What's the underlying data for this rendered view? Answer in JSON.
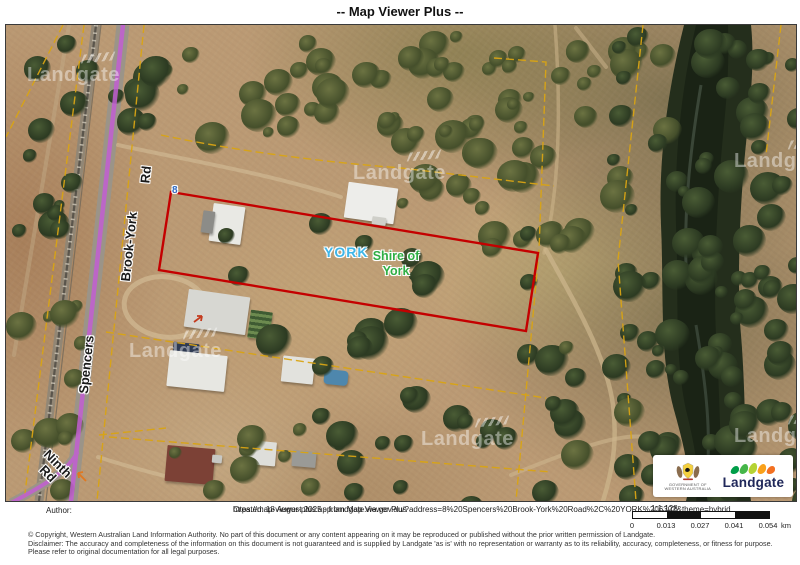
{
  "title": "-- Map Viewer Plus --",
  "map": {
    "watermark": "Landgate",
    "labels": {
      "road_part1": "Spencers",
      "road_part2": "Brook-York",
      "road_part3": "Rd",
      "ninth_line1": "Ninth",
      "ninth_line2": "Rd",
      "locality": "YORK",
      "lga_line1": "Shire of",
      "lga_line2": "York",
      "address_number": "8"
    },
    "colors": {
      "parcel_highlight": "#c40000",
      "route_highlight": "#c25ed2",
      "cadastral_line": "#d9a414",
      "locality_text": "#3fb6e8",
      "lga_text": "#2fae44",
      "address_text": "#2e6bc4"
    }
  },
  "logos": {
    "government_line1": "GOVERNMENT OF",
    "government_line2": "WESTERN AUSTRALIA",
    "landgate_text": "Landgate"
  },
  "footer": {
    "author_label": "Author:",
    "created_text": "Created: 18 August 2025 - from Map Viewer Plus",
    "url_text": "https://map-viewer-plus.app.landgate.wa.gov.au/?address=8%20Spencers%20Brook-York%20Road%2C%20YORK%206302&theme=hybrid",
    "scale_ratio": "1:1,128",
    "scale_bar": {
      "labels": [
        "0",
        "0.013",
        "0.027",
        "0.041",
        "0.054"
      ],
      "unit": "km"
    },
    "copyright_line1": "© Copyright, Western Australian Land Information Authority. No part of this document or any content appearing on it may be reproduced or published without the prior written permission of Landgate.",
    "copyright_line2": "Disclaimer: The accuracy and completeness of the information on this document is not guaranteed and is supplied by Landgate 'as is' with no representation or warranty as to its reliability, accuracy, completeness, or fitness for purpose.",
    "copyright_line3": "Please refer to original documentation for all legal purposes."
  }
}
